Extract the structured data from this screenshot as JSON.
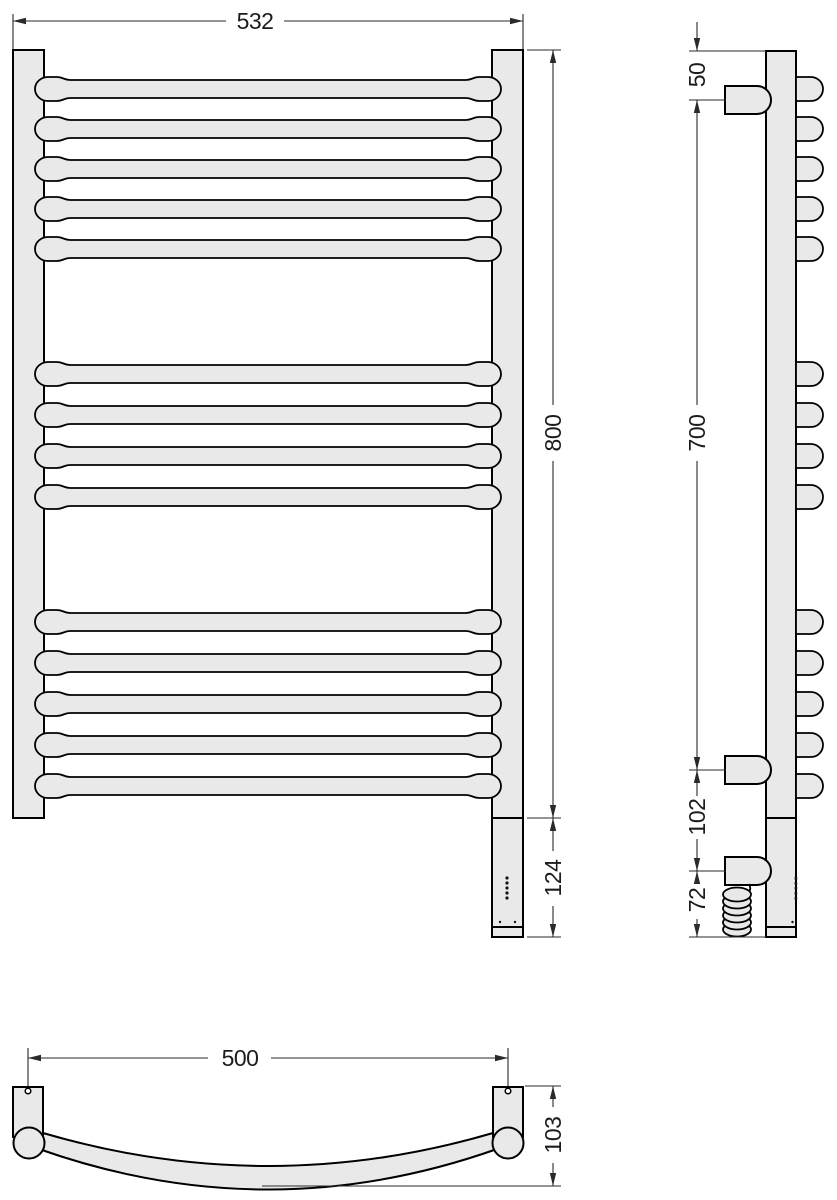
{
  "title": "towel-rail-technical-drawing",
  "colors": {
    "background": "#ffffff",
    "part_fill": "#e9e9e9",
    "outline": "#000000",
    "dimension": "#2a2a2a"
  },
  "views": {
    "front": {
      "name": "front-view",
      "bar_groups": [
        5,
        4,
        5
      ],
      "dimensions": {
        "overall_width": "532",
        "overall_height": "800",
        "heater_section": "124"
      }
    },
    "side": {
      "name": "side-view",
      "wall_brackets": 3,
      "dimensions": {
        "top_to_bracket": "50",
        "bracket_to_bracket": "700",
        "bracket_to_cable": "102",
        "cable_to_bottom": "72"
      }
    },
    "bottom": {
      "name": "bottom-view",
      "dimensions": {
        "mounting_span": "500",
        "depth": "103"
      }
    }
  }
}
